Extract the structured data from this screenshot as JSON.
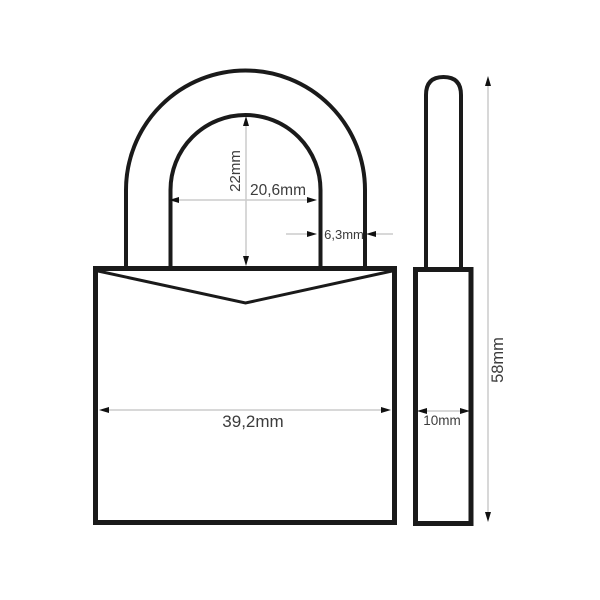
{
  "meta": {
    "description": "Technical dimension drawing of a padlock, front view and side view"
  },
  "dimensions": {
    "shackle_clearance_height": "22mm",
    "shackle_inner_width": "20,6mm",
    "shackle_diameter": "6,3mm",
    "body_width": "39,2mm",
    "body_depth": "10mm",
    "overall_height": "58mm"
  },
  "colors": {
    "outline": "#1a1a1a",
    "dimension_line": "#cccccc",
    "dimension_text": "#3c3c3c",
    "background": "#ffffff"
  }
}
